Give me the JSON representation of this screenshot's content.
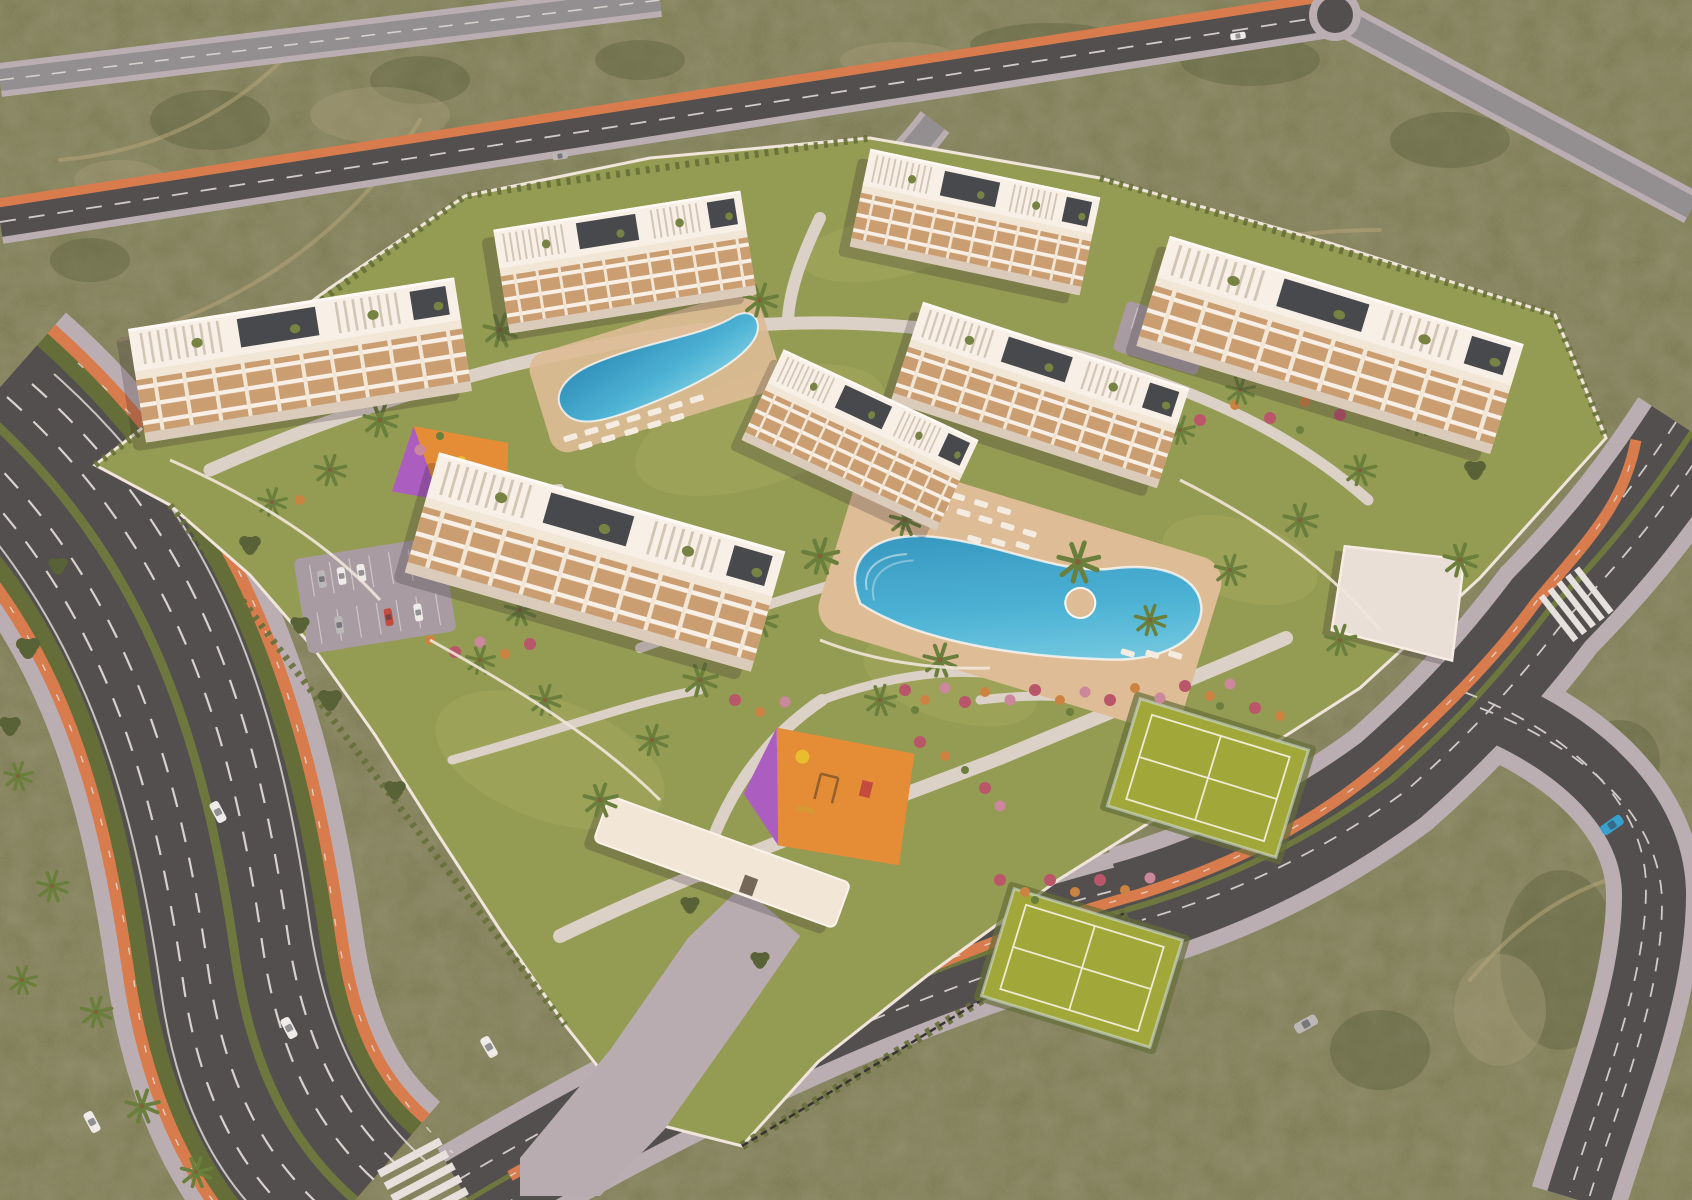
{
  "scene": {
    "kind": "aerial-architectural-render-residential-resort",
    "counts": {
      "apartment_blocks": 7,
      "swimming_pools": 2,
      "padel_courts": 2,
      "playgrounds": 2,
      "parking_lots": 2,
      "entrance_canopies": 1,
      "pool_pavilions": 1,
      "zebra_crossings": 2,
      "moving_cars": 8,
      "parked_cars": 8
    }
  },
  "colors": {
    "scrub_base": "#70744f",
    "scrub_dark": "#4e5a38",
    "scrub_light": "#9e9878",
    "sand_trail": "#b2a47c",
    "road_dark": "#47494d",
    "road_light": "#8b8c93",
    "sidewalk": "#b6afb7",
    "bike_lane": "#d5794b",
    "road_marking": "#e6e6e7",
    "hedge_green": "#5a6a34",
    "median_hedge": "#64753b",
    "grass": "#8c9a51",
    "lawn_light": "#9dac5f",
    "path_cream": "#dad4cd",
    "deck_tan": "#dcbe99",
    "pool_deep": "#1d86b9",
    "pool_mid": "#3fb3dc",
    "pool_light": "#8fe0f2",
    "building_white": "#f2ecdf",
    "building_shade": "#d8cec0",
    "balcony_tan": "#c79e72",
    "roof_white": "#f8f5ef",
    "pergola_line": "#cfc8bb",
    "solar_dark": "#3a424b",
    "roof_plant": "#6d8040",
    "court_green": "#9aa734",
    "court_line": "#eef0dc",
    "playground_orange": "#e38a33",
    "playground_purple": "#a558c6",
    "equip_yellow": "#e7c02a",
    "flower_red": "#b5506a",
    "flower_pink": "#c786a0",
    "flower_orange": "#c9813f",
    "palm_green": "#5f7c39",
    "tree_dark": "#4d5c33",
    "lounger_white": "#f5f2ea",
    "wall_white": "#efeae2",
    "fence_dark": "#2b2b30",
    "pavilion": "#e9e4de",
    "parking_asphalt": "#a29aa5",
    "driveway": "#b4adb6",
    "car_white": "#eef0f1",
    "car_silver": "#b6b9bd",
    "car_blue": "#2b9fd6",
    "car_red": "#c0453c",
    "shadow": "rgba(25,20,35,0.22)",
    "warm_tint": "rgba(255,170,110,0.07)"
  }
}
